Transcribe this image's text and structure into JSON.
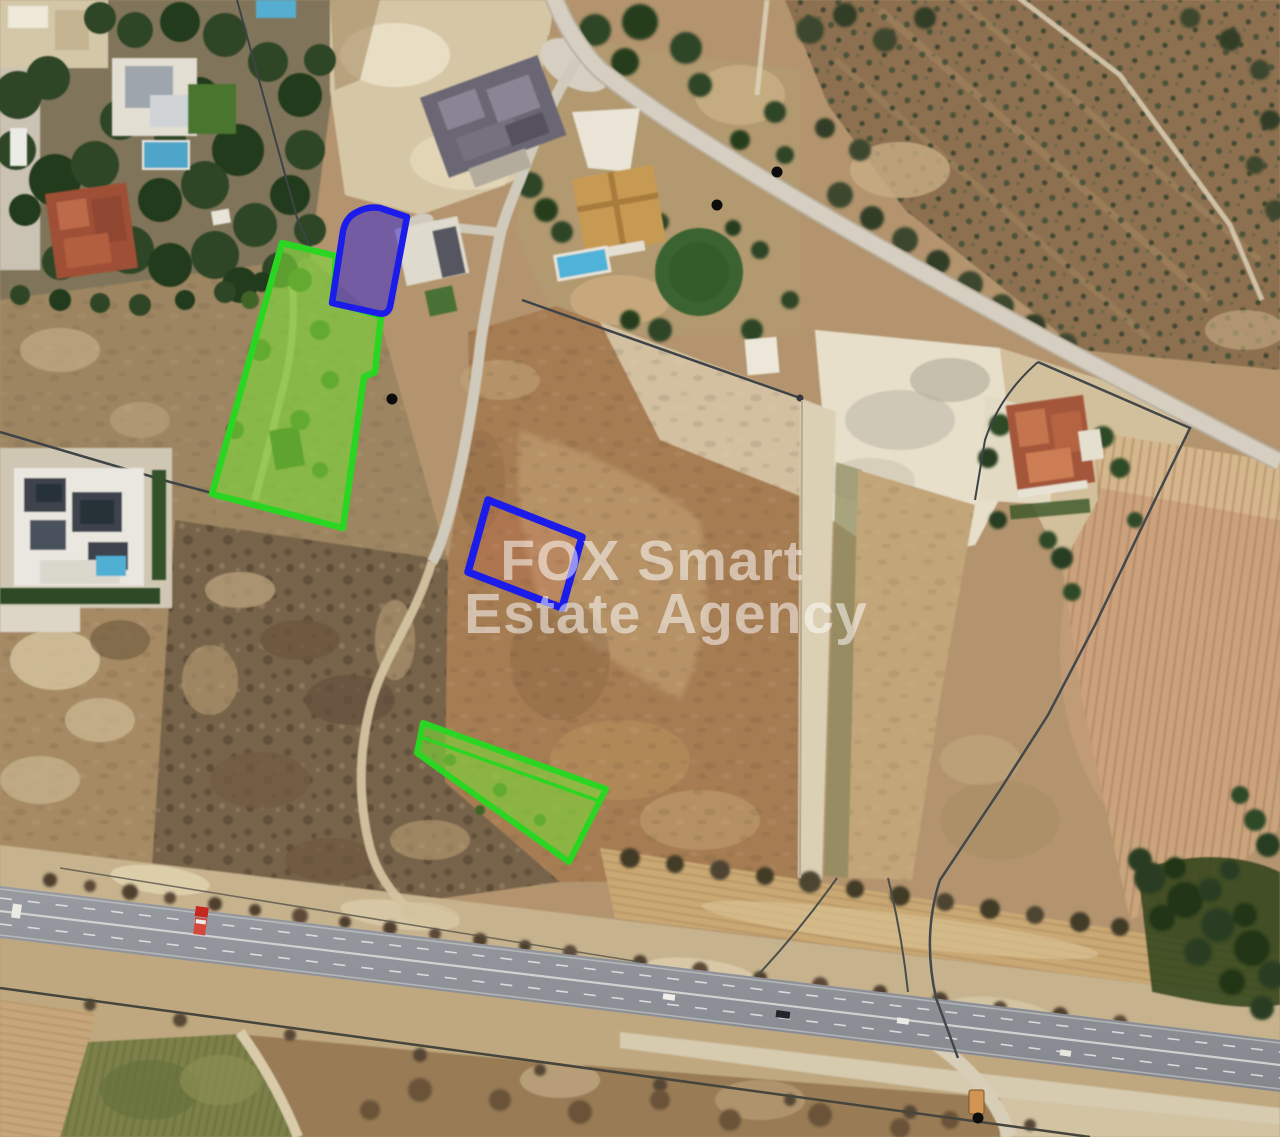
{
  "watermark": {
    "line1": "FOX Smart",
    "line2": "Estate Agency",
    "color": "#ffffff"
  },
  "plots": {
    "green_large": {
      "name": "highlighted-plot-green-north",
      "points": "282,243 336,256 333,302 381,316 375,372 364,377 343,528 212,494",
      "stroke": "#2ad622",
      "fill": "rgba(124,219,55,0.60)"
    },
    "green_strip": {
      "name": "highlighted-plot-green-south",
      "points": "423,723 606,789 569,862 417,753",
      "stroke": "#2ad622",
      "fill": "rgba(124,219,55,0.60)",
      "divider": {
        "x1": 421,
        "y1": 737,
        "x2": 599,
        "y2": 801
      }
    },
    "blue_fan": {
      "name": "highlighted-plot-blue-fan",
      "path": "M332,303 L343,231 Q346,217 357,212 Q368,206 380,208 L407,217 L390,307 Q387,316 377,313 Z",
      "stroke": "#1c1cea",
      "fill": "rgba(70,52,200,0.58)"
    },
    "blue_outline": {
      "name": "outlined-plot-blue-rectangle",
      "points": "488,500 582,537 562,608 468,572",
      "stroke": "#1c1cea",
      "fill": "rgba(210,90,70,0.16)"
    }
  },
  "markers": {
    "dots": [
      {
        "cx": 392,
        "cy": 399
      },
      {
        "cx": 717,
        "cy": 205
      },
      {
        "cx": 777,
        "cy": 172
      },
      {
        "cx": 978,
        "cy": 1118
      }
    ],
    "orange": {
      "x": 969,
      "y": 1090,
      "width": 15,
      "height": 24,
      "fill": "#d09552"
    }
  }
}
